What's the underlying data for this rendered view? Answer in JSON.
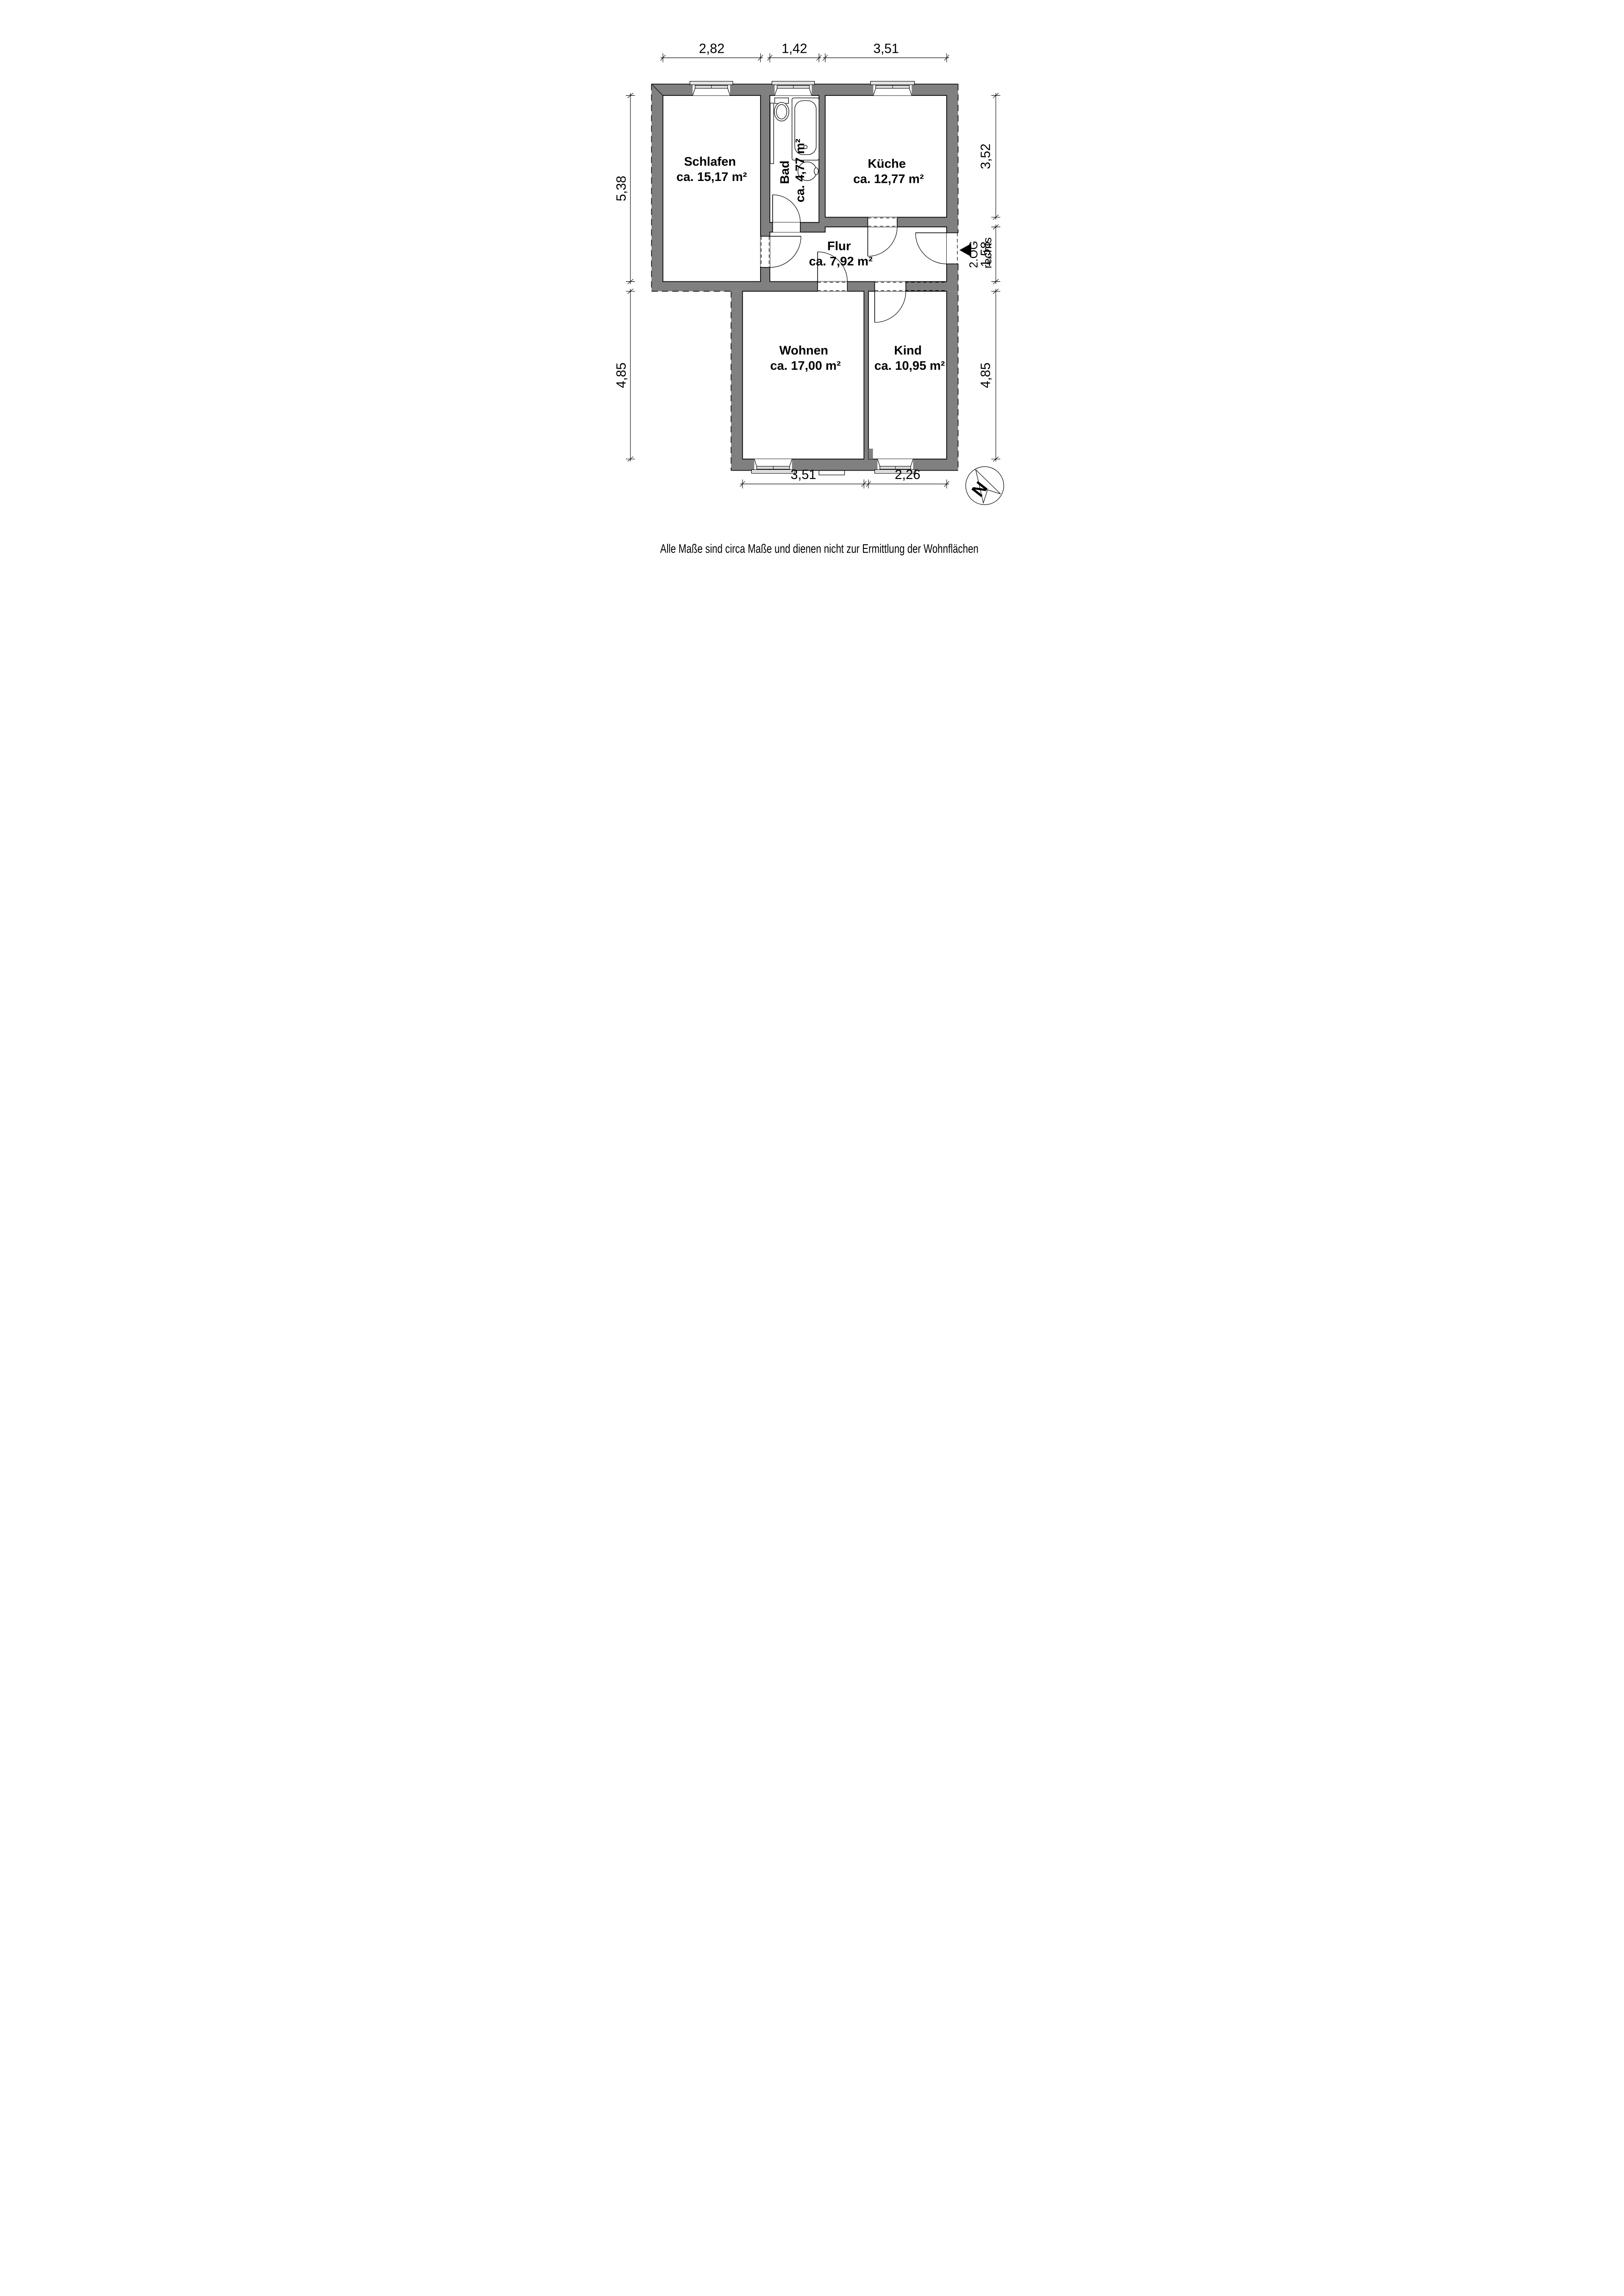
{
  "plan": {
    "disclaimer": "Alle Maße sind circa Maße und dienen nicht zur Ermittlung der Wohnflächen",
    "entrance": {
      "floor": "2.OG",
      "side": "rechts"
    },
    "north_letter": "N",
    "colors": {
      "wall": "#808080",
      "line": "#000000",
      "background": "#ffffff"
    },
    "rooms": [
      {
        "name": "Schlafen",
        "area": "ca. 15,17 m²"
      },
      {
        "name": "Bad",
        "area": "ca. 4,77 m²"
      },
      {
        "name": "Küche",
        "area": "ca. 12,77 m²"
      },
      {
        "name": "Flur",
        "area": "ca. 7,92 m²"
      },
      {
        "name": "Wohnen",
        "area": "ca. 17,00 m²"
      },
      {
        "name": "Kind",
        "area": "ca. 10,95 m²"
      }
    ],
    "dimensions": {
      "top": [
        "2,82",
        "1,42",
        "3,51"
      ],
      "left": [
        "5,38",
        "4,85"
      ],
      "right": [
        "3,52",
        "1,58",
        "4,85"
      ],
      "bottom": [
        "3,51",
        "2,26"
      ]
    }
  }
}
